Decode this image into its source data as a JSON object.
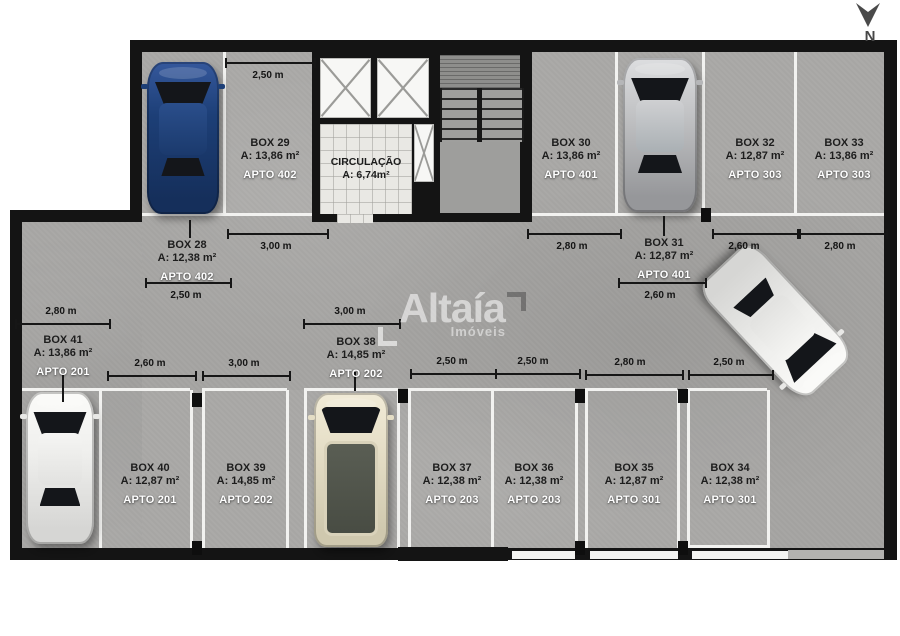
{
  "north": {
    "label": "N"
  },
  "logo": {
    "brand": "Altaía",
    "tagline": "Imóveis"
  },
  "circulation": {
    "title": "CIRCULAÇÃO",
    "area": "A: 6,74m²"
  },
  "boxes": [
    {
      "title": "BOX 28",
      "area": "A: 12,38 m²",
      "apto": "APTO 402"
    },
    {
      "title": "BOX 29",
      "area": "A: 13,86 m²",
      "apto": "APTO 402"
    },
    {
      "title": "BOX 30",
      "area": "A: 13,86 m²",
      "apto": "APTO 401"
    },
    {
      "title": "BOX 31",
      "area": "A: 12,87 m²",
      "apto": "APTO 401"
    },
    {
      "title": "BOX 32",
      "area": "A: 12,87 m²",
      "apto": "APTO 303"
    },
    {
      "title": "BOX 33",
      "area": "A: 13,86 m²",
      "apto": "APTO 303"
    },
    {
      "title": "BOX 34",
      "area": "A: 12,38 m²",
      "apto": "APTO 301"
    },
    {
      "title": "BOX 35",
      "area": "A: 12,87 m²",
      "apto": "APTO 301"
    },
    {
      "title": "BOX 36",
      "area": "A: 12,38 m²",
      "apto": "APTO 203"
    },
    {
      "title": "BOX 37",
      "area": "A: 12,38 m²",
      "apto": "APTO 203"
    },
    {
      "title": "BOX 38",
      "area": "A: 14,85 m²",
      "apto": "APTO 202"
    },
    {
      "title": "BOX 39",
      "area": "A: 14,85 m²",
      "apto": "APTO 202"
    },
    {
      "title": "BOX 40",
      "area": "A: 12,87 m²",
      "apto": "APTO 201"
    },
    {
      "title": "BOX 41",
      "area": "A: 13,86 m²",
      "apto": "APTO 201"
    }
  ],
  "dimensions": [
    {
      "label": "2,50 m"
    },
    {
      "label": "3,00 m"
    },
    {
      "label": "2,80 m"
    },
    {
      "label": "2,60 m"
    },
    {
      "label": "2,80 m"
    },
    {
      "label": "2,50 m"
    },
    {
      "label": "2,60 m"
    },
    {
      "label": "2,80 m"
    },
    {
      "label": "2,60 m"
    },
    {
      "label": "3,00 m"
    },
    {
      "label": "3,00 m"
    },
    {
      "label": "2,50 m"
    },
    {
      "label": "2,50 m"
    },
    {
      "label": "2,80 m"
    },
    {
      "label": "2,50 m"
    }
  ],
  "cars": [
    {
      "name": "blue-car"
    },
    {
      "name": "silver-car"
    },
    {
      "name": "white-car"
    },
    {
      "name": "cream-van"
    },
    {
      "name": "white-car-driving"
    }
  ]
}
